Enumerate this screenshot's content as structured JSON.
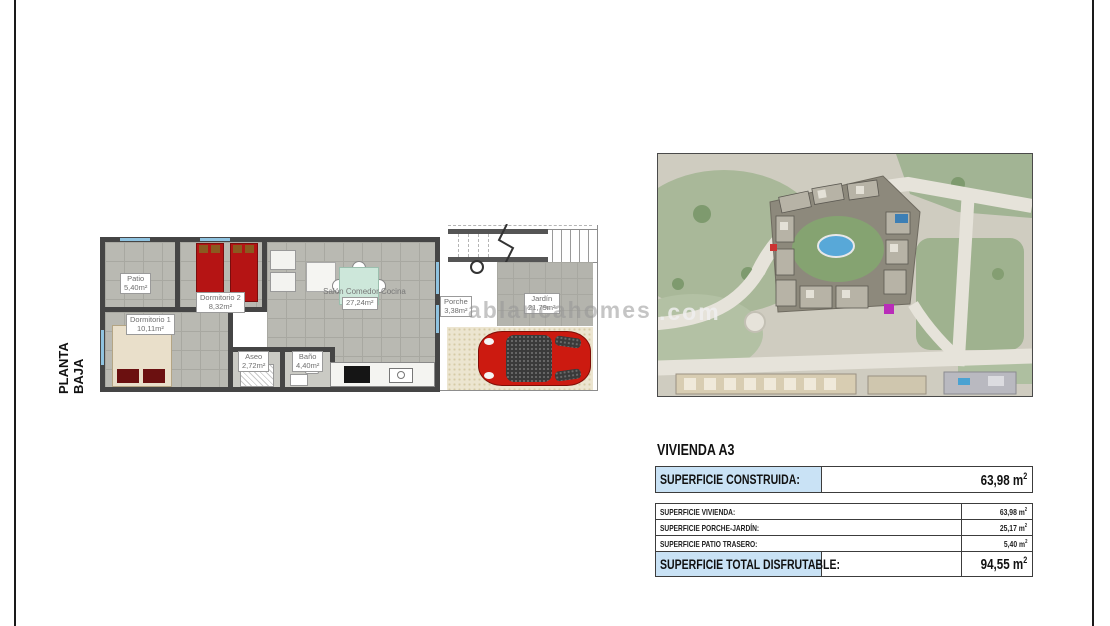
{
  "page": {
    "floor_label": "PLANTA BAJA",
    "watermark_left": "ablancahomes",
    "watermark_right": ".com"
  },
  "floor_plan": {
    "rooms": [
      {
        "name": "Patio",
        "area": "5,40m²"
      },
      {
        "name": "Dormitorio 2",
        "area": "8,32m²"
      },
      {
        "name": "Dormitorio 1",
        "area": "10,11m²"
      },
      {
        "name": "Aseo",
        "area": "2,72m²"
      },
      {
        "name": "Baño",
        "area": "4,40m²"
      },
      {
        "name": "Salón  Comedor  Cocina",
        "area": "27,24m²"
      },
      {
        "name": "Porche",
        "area": "3,38m²"
      },
      {
        "name": "Jardín",
        "area": "21,79m²"
      }
    ]
  },
  "summary": {
    "title": "VIVIENDA A3",
    "unit": "m",
    "unit_sup": "2",
    "construida": {
      "label": "SUPERFICIE CONSTRUIDA:",
      "value": "63,98"
    },
    "rows": [
      {
        "label": "SUPERFICIE VIVIENDA:",
        "value": "63,98"
      },
      {
        "label": "SUPERFICIE PORCHE-JARDÍN:",
        "value": "25,17"
      },
      {
        "label": "SUPERFICIE PATIO TRASERO:",
        "value": "5,40"
      }
    ],
    "total": {
      "label": "SUPERFICIE TOTAL DISFRUTABLE:",
      "value": "94,55"
    }
  },
  "colors": {
    "highlight_blue": "#c9e2f5",
    "wall": "#454545",
    "floor_gray": "#b9b9b2",
    "bed_red": "#b51414",
    "car_red": "#cc1a10",
    "pool_blue": "#58a8d8",
    "marker_purple": "#b92cb9"
  }
}
